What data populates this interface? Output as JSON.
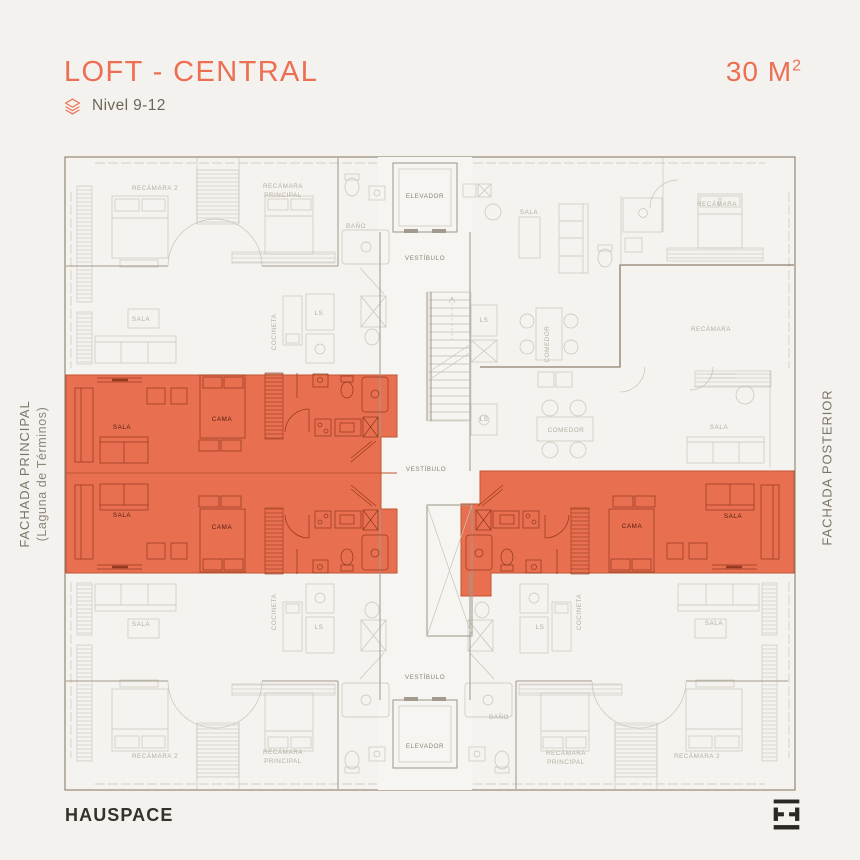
{
  "theme": {
    "bg": "#f4f2ee",
    "accent": "#ec6f53",
    "ink": "#35322c",
    "subtle": "#6e665a",
    "facade": "#7d7467",
    "facade2": "#8f8679",
    "zone_fill": "#e87050",
    "zone_edge": "#c2552f",
    "line_light": "#c9c3b9",
    "line_medium": "#a29a8c",
    "line_dark": "#8d7e6c",
    "line_red": "#96391f",
    "text_gray": "#b5aea3",
    "text_core": "#8d8477",
    "text_loft": "#55200f"
  },
  "header": {
    "title": "LOFT - CENTRAL",
    "area_value": "30 M",
    "area_sup": "2",
    "level_label": "Nivel 9-12"
  },
  "facades": {
    "left_line1": "FACHADA PRINCIPAL",
    "left_line2": "(Laguna de Términos)",
    "right_line1": "FACHADA POSTERIOR"
  },
  "footer": {
    "brand": "HAUSPACE"
  },
  "plan": {
    "labels": [
      {
        "t": "RECÁMARA  2",
        "x": 155,
        "y": 190,
        "k": "g"
      },
      {
        "t": "RECÁMARA",
        "x": 283,
        "y": 188,
        "k": "g"
      },
      {
        "t": "PRINCIPAL",
        "x": 283,
        "y": 197,
        "k": "g"
      },
      {
        "t": "BAÑO",
        "x": 356,
        "y": 228,
        "k": "g"
      },
      {
        "t": "SALA",
        "x": 141,
        "y": 321,
        "k": "g"
      },
      {
        "t": "COCINETA",
        "x": 276,
        "y": 332,
        "k": "g",
        "r": -90
      },
      {
        "t": "LS",
        "x": 319,
        "y": 315,
        "k": "g"
      },
      {
        "t": "SALA",
        "x": 529,
        "y": 214,
        "k": "g"
      },
      {
        "t": "RECÁMARA",
        "x": 717,
        "y": 206,
        "k": "g"
      },
      {
        "t": "LS",
        "x": 484,
        "y": 322,
        "k": "g"
      },
      {
        "t": "COMEDOR",
        "x": 549,
        "y": 344,
        "k": "g",
        "r": -90
      },
      {
        "t": "RECÁMARA",
        "x": 711,
        "y": 331,
        "k": "g"
      },
      {
        "t": "LS",
        "x": 484,
        "y": 421,
        "k": "g"
      },
      {
        "t": "COMEDOR",
        "x": 566,
        "y": 432,
        "k": "g"
      },
      {
        "t": "SALA",
        "x": 719,
        "y": 429,
        "k": "g"
      },
      {
        "t": "SALA",
        "x": 141,
        "y": 626,
        "k": "g"
      },
      {
        "t": "COCINETA",
        "x": 276,
        "y": 612,
        "k": "g",
        "r": -90
      },
      {
        "t": "LS",
        "x": 319,
        "y": 629,
        "k": "g"
      },
      {
        "t": "RECÁMARA  2",
        "x": 155,
        "y": 758,
        "k": "g"
      },
      {
        "t": "RECÁMARA",
        "x": 283,
        "y": 754,
        "k": "g"
      },
      {
        "t": "PRINCIPAL",
        "x": 283,
        "y": 763,
        "k": "g"
      },
      {
        "t": "LS",
        "x": 540,
        "y": 629,
        "k": "g"
      },
      {
        "t": "COCINETA",
        "x": 581,
        "y": 612,
        "k": "g",
        "r": -90
      },
      {
        "t": "SALA",
        "x": 714,
        "y": 625,
        "k": "g"
      },
      {
        "t": "BAÑO",
        "x": 499,
        "y": 719,
        "k": "g"
      },
      {
        "t": "RECÁMARA",
        "x": 566,
        "y": 755,
        "k": "g"
      },
      {
        "t": "PRINCIPAL",
        "x": 566,
        "y": 764,
        "k": "g"
      },
      {
        "t": "RECÁMARA  2",
        "x": 697,
        "y": 758,
        "k": "g"
      },
      {
        "t": "ELEVADOR",
        "x": 425,
        "y": 198,
        "k": "c"
      },
      {
        "t": "VESTÍBULO",
        "x": 425,
        "y": 260,
        "k": "c"
      },
      {
        "t": "VESTÍBULO",
        "x": 426,
        "y": 471,
        "k": "c"
      },
      {
        "t": "VESTÍBULO",
        "x": 425,
        "y": 679,
        "k": "c"
      },
      {
        "t": "ELEVADOR",
        "x": 425,
        "y": 748,
        "k": "c"
      },
      {
        "t": "SALA",
        "x": 122,
        "y": 429,
        "k": "o"
      },
      {
        "t": "CAMA",
        "x": 222,
        "y": 421,
        "k": "o"
      },
      {
        "t": "SALA",
        "x": 122,
        "y": 517,
        "k": "o"
      },
      {
        "t": "CAMA",
        "x": 222,
        "y": 529,
        "k": "o"
      },
      {
        "t": "CAMA",
        "x": 632,
        "y": 528,
        "k": "o"
      },
      {
        "t": "SALA",
        "x": 733,
        "y": 518,
        "k": "o"
      }
    ]
  }
}
